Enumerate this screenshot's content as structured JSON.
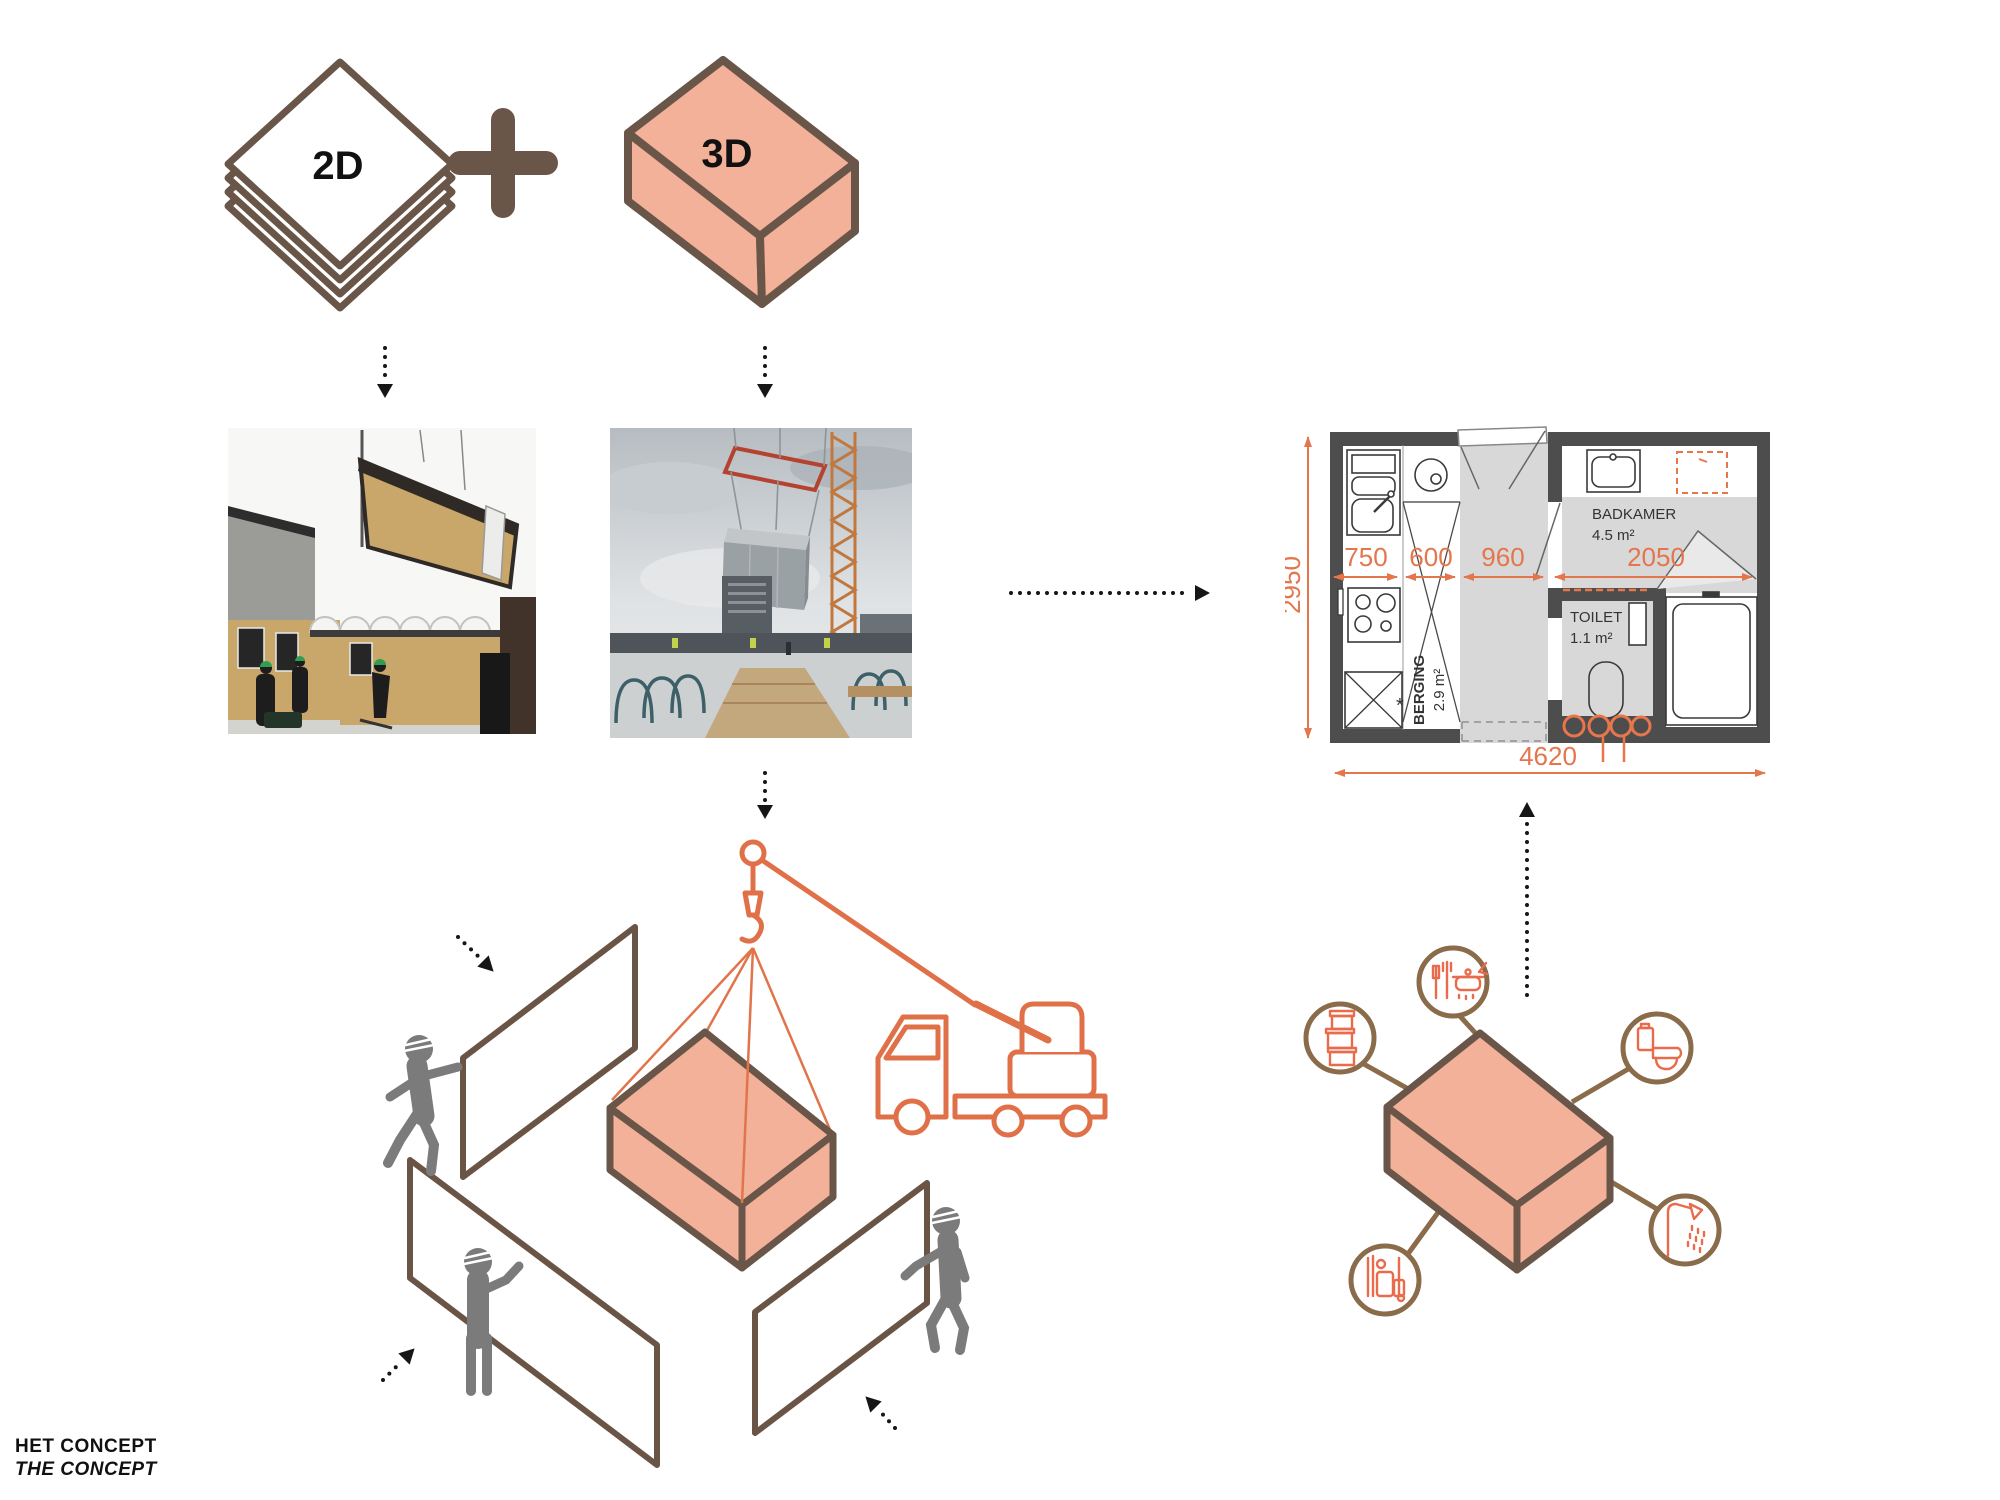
{
  "formula": {
    "label_2d": "2D",
    "plus": "+",
    "label_3d": "3D"
  },
  "floor_plan": {
    "dim_height": "2950",
    "dim_width": "4620",
    "dim_segments": [
      "750",
      "600",
      "960",
      "2050"
    ],
    "rooms": {
      "badkamer": {
        "name": "BADKAMER",
        "area": "4.5 m²"
      },
      "toilet": {
        "name": "TOILET",
        "area": "1.1 m²"
      },
      "berging": {
        "name": "BERGING",
        "area": "2.9 m²"
      }
    },
    "asterisk": "*"
  },
  "module_features": {
    "items": [
      "storage-boxes-icon",
      "cooking-icon",
      "toilet-icon",
      "shower-icon",
      "installations-icon"
    ]
  },
  "footer": {
    "title_nl": "HET CONCEPT",
    "title_en": "THE CONCEPT"
  },
  "colors": {
    "salmon": "#F2B198",
    "outline_brown": "#6A5649",
    "accent_orange": "#E07048",
    "dim_orange": "#E4764E",
    "icon_brown": "#8A6B4A",
    "icon_orange": "#E96B4C",
    "wall_gray": "#4D4D4D",
    "floor_gray": "#D8D8D8",
    "worker_gray": "#7B7B7B"
  }
}
